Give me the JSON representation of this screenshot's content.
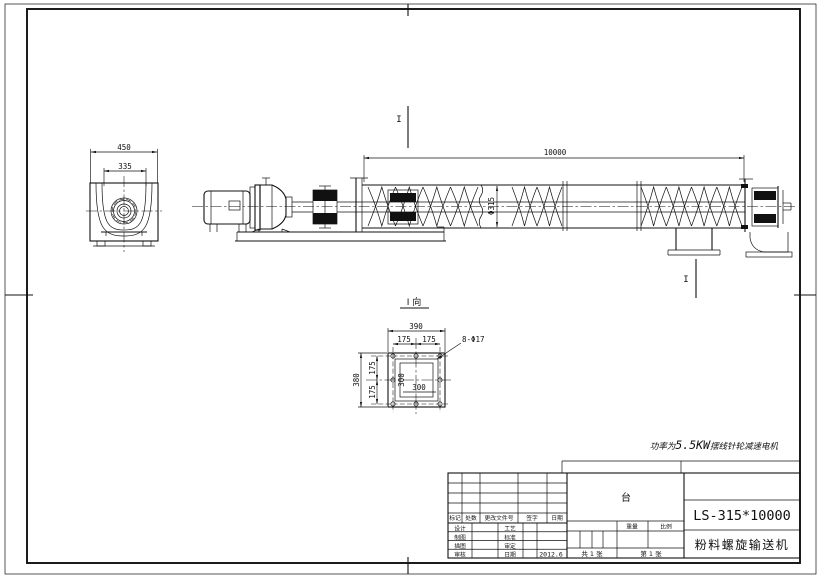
{
  "colors": {
    "ink": "#111111",
    "paper": "#ffffff"
  },
  "drawing": {
    "power_note": {
      "prefix": "功率为",
      "value": "5.5KW",
      "suffix": "摆线针轮减速电机"
    },
    "main_view": {
      "dim_length": "10000",
      "dim_diameter": "Φ315"
    },
    "end_view": {
      "dim_outer": "450",
      "dim_inner": "335"
    },
    "section_marker_top": "I",
    "section_marker_bottom": "I",
    "detail_view": {
      "title": "I 向",
      "dim_width_total": "390",
      "dim_w_half1": "175",
      "dim_w_half2": "175",
      "holes_note": "8-Φ17",
      "dim_height_total": "380",
      "dim_h_half1": "175",
      "dim_h_half2": "175",
      "dim_inner_w": "300",
      "dim_inner_h": "300"
    }
  },
  "title_block": {
    "model": "LS-315*10000",
    "product_name": "粉料螺旋输送机",
    "unit_label": "台",
    "rev_headers": [
      "标记",
      "处数",
      "更改文件号",
      "签字",
      "日期"
    ],
    "sign_rows": [
      [
        "设计",
        "工艺"
      ],
      [
        "制图",
        "标准"
      ],
      [
        "描图",
        "审定"
      ],
      [
        "审核",
        "日期"
      ]
    ],
    "date": "2012.6",
    "weight_label": "重量",
    "scale_label": "比例",
    "sheet_total": "共 1 张",
    "sheet_no": "第 1 张"
  }
}
